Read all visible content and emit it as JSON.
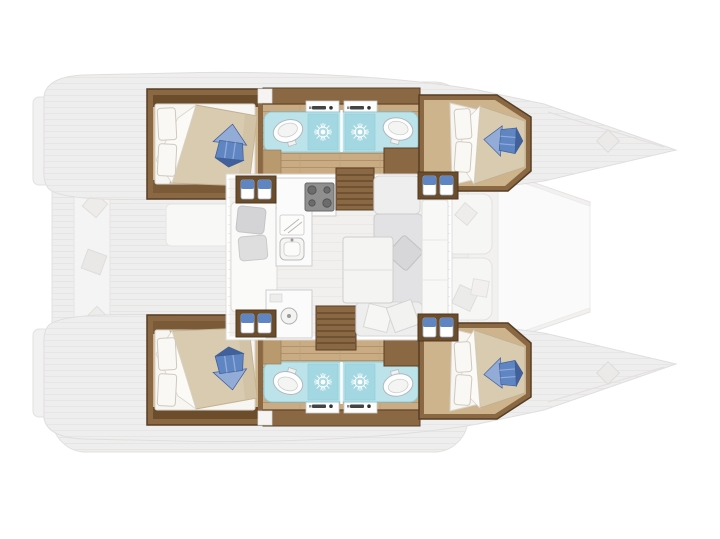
{
  "meta": {
    "title": "catamaran-4-cabin-layout-floor-plan",
    "view": "top-down",
    "bow_direction": "right",
    "visible_text": "none"
  },
  "colors": {
    "background": "#ffffff",
    "deck": "#efeeee",
    "deck_stroke": "#e2e0df",
    "deck_line": "#e6e4e1",
    "platform_white": "#fafafa",
    "plank_floor": "#c9ac83",
    "plank_line": "#b2926a",
    "wood_dark": "#6b4c2b",
    "wood_mid": "#8a6844",
    "wood_frame_stroke": "#563e24",
    "cabin_floor": "#cdb48d",
    "duvet": "#d8cbb0",
    "linen_white": "#f7f6f2",
    "cushion_blue": "#5f86c2",
    "cushion_blue_light": "#93acd7",
    "cushion_blue_dark": "#42619b",
    "bathroom_floor": "#bce3ea",
    "shower_tile": "#a3d7e1",
    "bathroom_stroke": "#8fcbd6",
    "fixture_white": "#fdfdfd",
    "saloon_floor": "#f1f0ee",
    "sofa_gray": "#e2e2e4",
    "pillow_gray": "#d4d4d6",
    "counter_white": "#fbfbfb",
    "stove_gray": "#8f8f8f",
    "table_white": "#f4f4f3"
  },
  "elements": {
    "hulls": [
      "port-hull",
      "starboard-hull"
    ],
    "rooms_per_hull": [
      "aft-double-cabin",
      "bathroom-with-shower",
      "forward-double-cabin"
    ],
    "center": [
      "aft-cockpit",
      "saloon-galley-dinette",
      "companionway-stairs-port",
      "companionway-stairs-starboard",
      "foredeck-sunpads",
      "foredeck-platform"
    ],
    "fixtures": [
      "toilet",
      "vanity-sink",
      "shower-head",
      "stove",
      "galley-sink",
      "dinette-table",
      "sofa",
      "blue-cushion",
      "locker-unit",
      "transom-steps"
    ]
  }
}
